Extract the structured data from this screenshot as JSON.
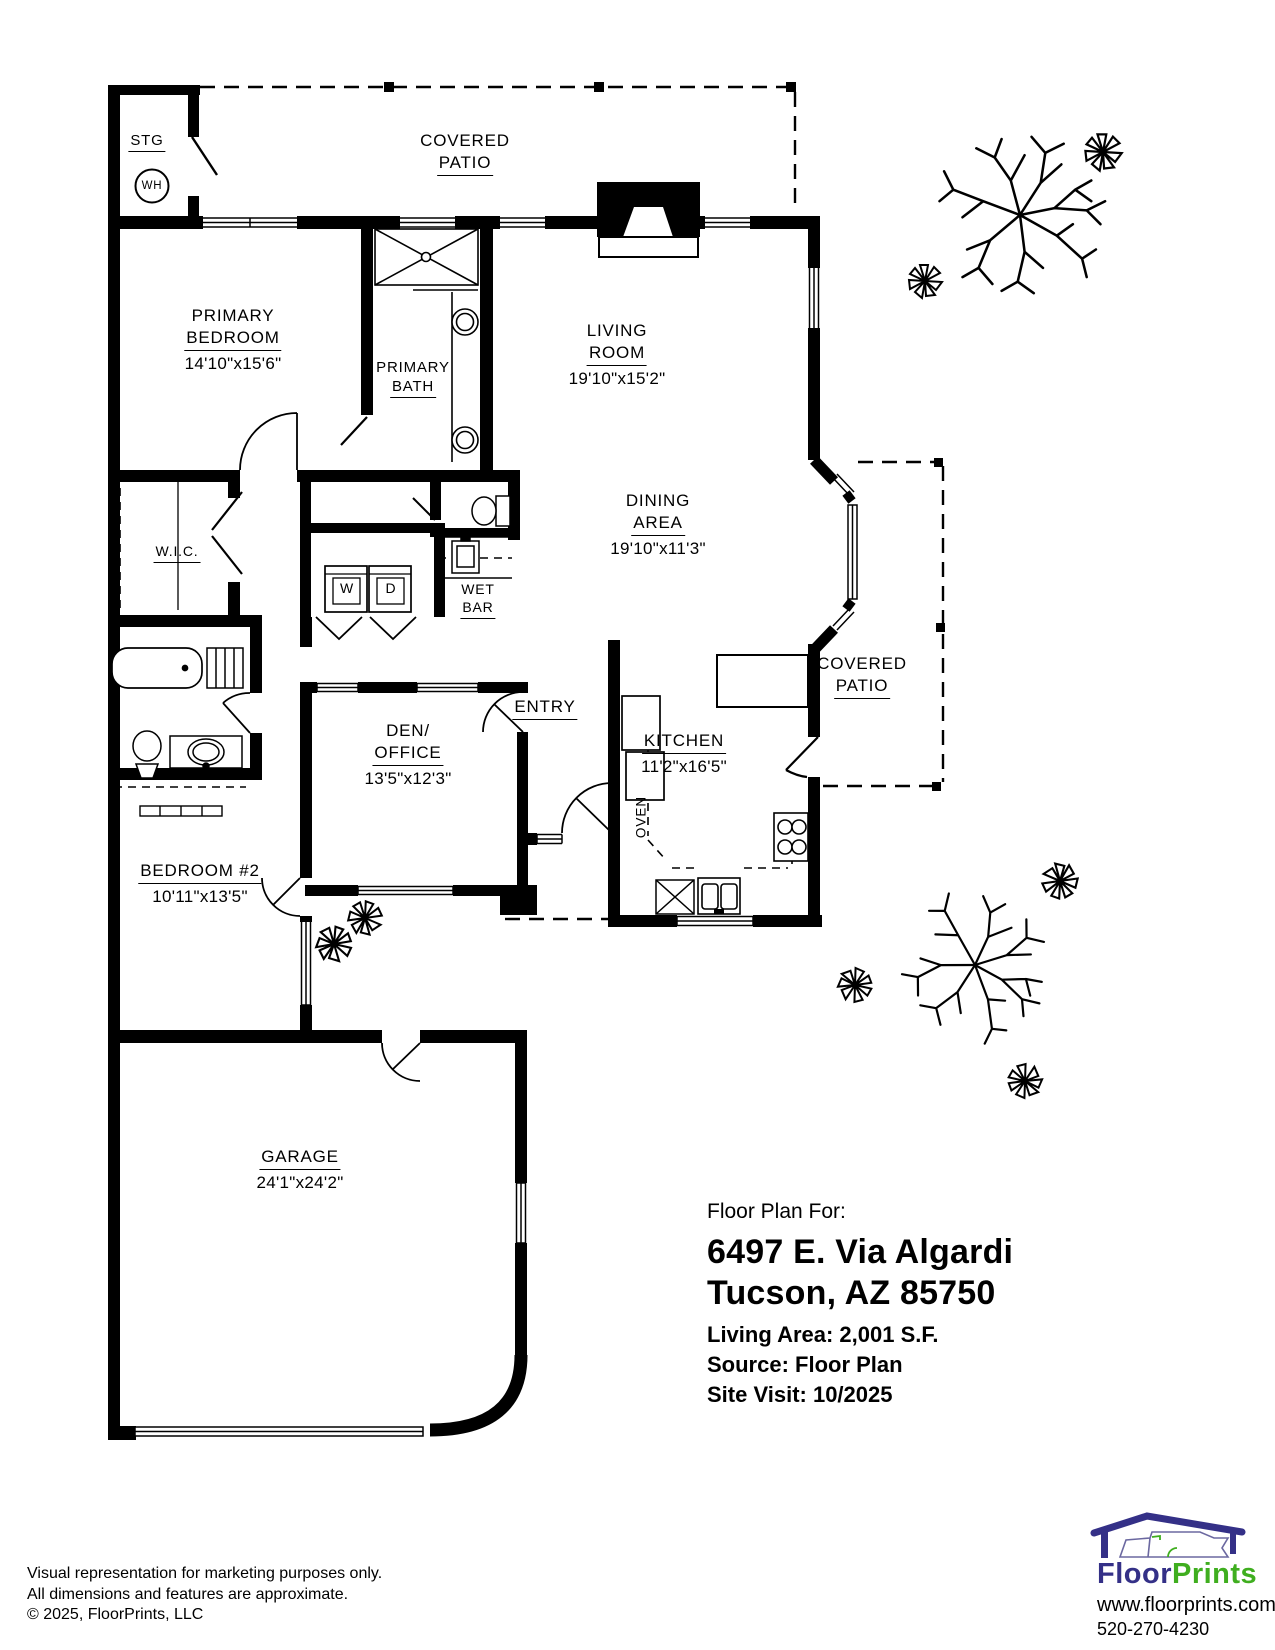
{
  "rooms": {
    "stg": {
      "name": "STG"
    },
    "water_heater": {
      "label": "WH"
    },
    "patio_top": {
      "l1": "COVERED",
      "l2": "PATIO"
    },
    "primary_bedroom": {
      "l1": "PRIMARY",
      "l2": "BEDROOM",
      "dims": "14'10\"x15'6\""
    },
    "primary_bath": {
      "l1": "PRIMARY",
      "l2": "BATH"
    },
    "living_room": {
      "l1": "LIVING",
      "l2": "ROOM",
      "dims": "19'10\"x15'2\""
    },
    "dining_area": {
      "l1": "DINING",
      "l2": "AREA",
      "dims": "19'10\"x11'3\""
    },
    "wic": {
      "name": "W.I.C."
    },
    "wet_bar": {
      "l1": "WET",
      "l2": "BAR"
    },
    "washer": {
      "label": "W"
    },
    "dryer": {
      "label": "D"
    },
    "den_office": {
      "l1": "DEN/",
      "l2": "OFFICE",
      "dims": "13'5\"x12'3\""
    },
    "entry": {
      "name": "ENTRY"
    },
    "oven": {
      "label": "OVEN"
    },
    "kitchen": {
      "name": "KITCHEN",
      "dims": "11'2\"x16'5\""
    },
    "patio_right": {
      "l1": "COVERED",
      "l2": "PATIO"
    },
    "bedroom2": {
      "name": "BEDROOM #2",
      "dims": "10'11\"x13'5\""
    },
    "garage": {
      "name": "GARAGE",
      "dims": "24'1\"x24'2\""
    }
  },
  "info": {
    "heading": "Floor Plan For:",
    "address_line1": "6497 E. Via Algardi",
    "address_line2": "Tucson, AZ  85750",
    "living_area": "Living Area:  2,001 S.F.",
    "source": "Source:  Floor Plan",
    "site_visit": "Site Visit:  10/2025"
  },
  "footer": {
    "line1": "Visual representation for marketing purposes only.",
    "line2": "All dimensions and features are approximate.",
    "line3": "© 2025, FloorPrints, LLC"
  },
  "logo": {
    "brand_floor": "Floor",
    "brand_prints": "Prints",
    "website": "www.floorprints.com",
    "phone": "520-270-4230",
    "navy": "#343087",
    "green": "#3fae1f"
  }
}
